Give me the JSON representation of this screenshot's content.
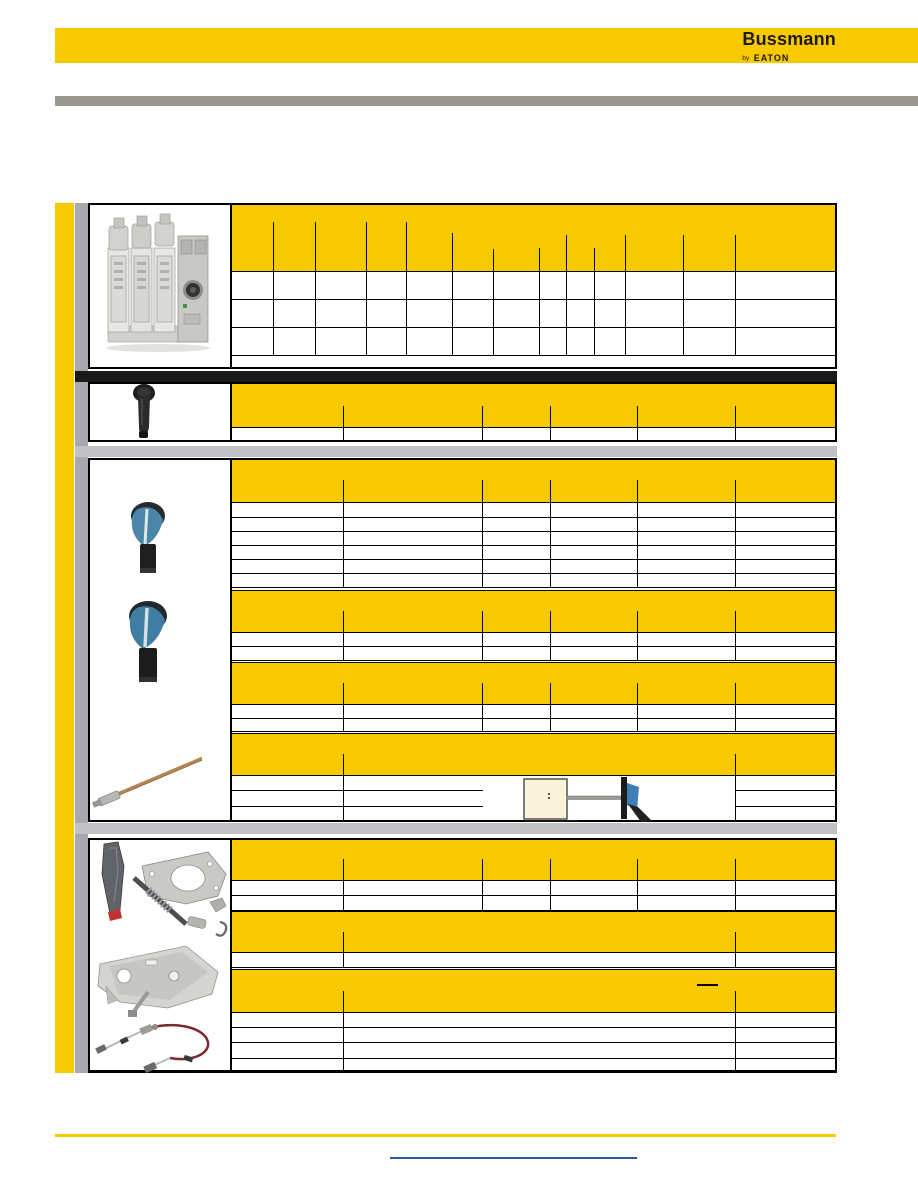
{
  "brand": {
    "name": "Bussmann",
    "byline": "by",
    "parent": "EATON"
  },
  "colors": {
    "yellow": "#F7CA00",
    "top_gray": "#97978F",
    "separator_gray": "#C2C2C5",
    "stripe_gray": "#A9A9AC",
    "black_bar": "#1A1A1A",
    "link_blue": "#2B57A8",
    "border": "#000000",
    "page_bg": "#FFFFFF"
  },
  "footer": {
    "link_underline_only": true
  },
  "images": [
    "fuse-switch-disconnector-product-photo",
    "black-rotary-handle-photo",
    "blue-rotary-handle-photo",
    "blue-rotary-handle-large-photo",
    "extension-shaft-photo",
    "interlock-mechanism-parts-photo",
    "mounting-bracket-plate-photo",
    "bowden-cable-photo",
    "door-mounted-handle-diagram"
  ],
  "grid": {
    "bars": [
      {
        "n": "left-yellow-stripe",
        "x": 55,
        "y": 203,
        "w": 19,
        "h": 870,
        "c": "yellow"
      },
      {
        "n": "left-gray-stripe",
        "x": 75,
        "y": 203,
        "w": 13,
        "h": 870,
        "c": "stripe_gray"
      },
      {
        "n": "black-separator-bar",
        "x": 75,
        "y": 371,
        "w": 762,
        "h": 11,
        "c": "black_bar"
      },
      {
        "n": "gray-separator-bar-1",
        "x": 75,
        "y": 446,
        "w": 762,
        "h": 11,
        "c": "separator_gray"
      },
      {
        "n": "gray-separator-bar-2",
        "x": 75,
        "y": 823,
        "w": 762,
        "h": 11,
        "c": "separator_gray"
      }
    ],
    "bands": [
      [
        230,
        203,
        607,
        68
      ],
      [
        230,
        383,
        607,
        44
      ],
      [
        230,
        458,
        607,
        44
      ],
      [
        230,
        590,
        607,
        42
      ],
      [
        230,
        662,
        607,
        42
      ],
      [
        230,
        733,
        607,
        42
      ],
      [
        230,
        838,
        607,
        42
      ],
      [
        230,
        911,
        607,
        41
      ],
      [
        230,
        969,
        607,
        43
      ]
    ],
    "boxes": [
      [
        88,
        203,
        749,
        166
      ],
      [
        88,
        382,
        749,
        60
      ],
      [
        88,
        458,
        749,
        364
      ],
      [
        88,
        838,
        749,
        235
      ]
    ],
    "hlines": [
      [
        230,
        271,
        607
      ],
      [
        230,
        299,
        607
      ],
      [
        230,
        327,
        607
      ],
      [
        230,
        355,
        607
      ],
      [
        230,
        427,
        607
      ],
      [
        230,
        502,
        607
      ],
      [
        230,
        517,
        607
      ],
      [
        230,
        531,
        607
      ],
      [
        230,
        545,
        607
      ],
      [
        230,
        559,
        607
      ],
      [
        230,
        573,
        607
      ],
      [
        230,
        587,
        607
      ],
      [
        230,
        590,
        607
      ],
      [
        230,
        632,
        607
      ],
      [
        230,
        646,
        607
      ],
      [
        230,
        660,
        607
      ],
      [
        230,
        662,
        607
      ],
      [
        230,
        704,
        607
      ],
      [
        230,
        718,
        607
      ],
      [
        230,
        731,
        607
      ],
      [
        230,
        733,
        607
      ],
      [
        230,
        775,
        607
      ],
      [
        230,
        790,
        253
      ],
      [
        230,
        806,
        253
      ],
      [
        735,
        790,
        102
      ],
      [
        735,
        806,
        102
      ],
      [
        230,
        880,
        607
      ],
      [
        230,
        895,
        607
      ],
      [
        230,
        910,
        607
      ],
      [
        230,
        911,
        607
      ],
      [
        230,
        952,
        607
      ],
      [
        230,
        967,
        607
      ],
      [
        230,
        969,
        607
      ],
      [
        230,
        1012,
        607
      ],
      [
        230,
        1027,
        607
      ],
      [
        230,
        1042,
        607
      ],
      [
        230,
        1058,
        607
      ],
      [
        697,
        984,
        21,
        2
      ]
    ],
    "vlines": [
      [
        230,
        203,
        166,
        2
      ],
      [
        230,
        382,
        60,
        2
      ],
      [
        230,
        458,
        364,
        2
      ],
      [
        230,
        838,
        235,
        2
      ],
      [
        273,
        222,
        49
      ],
      [
        315,
        222,
        49
      ],
      [
        366,
        222,
        49
      ],
      [
        406,
        222,
        49
      ],
      [
        452,
        233,
        38
      ],
      [
        493,
        249,
        22
      ],
      [
        539,
        248,
        23
      ],
      [
        566,
        235,
        36
      ],
      [
        594,
        248,
        23
      ],
      [
        625,
        235,
        36
      ],
      [
        683,
        235,
        36
      ],
      [
        735,
        235,
        36
      ],
      [
        273,
        271,
        84
      ],
      [
        315,
        271,
        84
      ],
      [
        366,
        271,
        84
      ],
      [
        406,
        271,
        84
      ],
      [
        452,
        271,
        84
      ],
      [
        493,
        271,
        84
      ],
      [
        539,
        271,
        84
      ],
      [
        566,
        271,
        84
      ],
      [
        594,
        271,
        84
      ],
      [
        625,
        271,
        84
      ],
      [
        683,
        271,
        84
      ],
      [
        735,
        271,
        84
      ],
      [
        343,
        406,
        21
      ],
      [
        482,
        406,
        21
      ],
      [
        550,
        406,
        21
      ],
      [
        637,
        406,
        21
      ],
      [
        735,
        406,
        21
      ],
      [
        343,
        427,
        15
      ],
      [
        482,
        427,
        15
      ],
      [
        550,
        427,
        15
      ],
      [
        637,
        427,
        15
      ],
      [
        735,
        427,
        15
      ],
      [
        343,
        480,
        22
      ],
      [
        482,
        480,
        22
      ],
      [
        550,
        480,
        22
      ],
      [
        637,
        480,
        22
      ],
      [
        735,
        480,
        22
      ],
      [
        343,
        502,
        85
      ],
      [
        482,
        502,
        85
      ],
      [
        550,
        502,
        85
      ],
      [
        637,
        502,
        85
      ],
      [
        735,
        502,
        85
      ],
      [
        343,
        611,
        21
      ],
      [
        482,
        611,
        21
      ],
      [
        550,
        611,
        21
      ],
      [
        637,
        611,
        21
      ],
      [
        735,
        611,
        21
      ],
      [
        343,
        632,
        28
      ],
      [
        482,
        632,
        28
      ],
      [
        550,
        632,
        28
      ],
      [
        637,
        632,
        28
      ],
      [
        735,
        632,
        28
      ],
      [
        343,
        683,
        21
      ],
      [
        482,
        683,
        21
      ],
      [
        550,
        683,
        21
      ],
      [
        637,
        683,
        21
      ],
      [
        735,
        683,
        21
      ],
      [
        343,
        704,
        27
      ],
      [
        482,
        704,
        27
      ],
      [
        550,
        704,
        27
      ],
      [
        637,
        704,
        27
      ],
      [
        735,
        704,
        27
      ],
      [
        343,
        754,
        21
      ],
      [
        735,
        754,
        21
      ],
      [
        343,
        775,
        47
      ],
      [
        735,
        775,
        47
      ],
      [
        343,
        859,
        21
      ],
      [
        482,
        859,
        21
      ],
      [
        550,
        859,
        21
      ],
      [
        637,
        859,
        21
      ],
      [
        735,
        859,
        21
      ],
      [
        343,
        880,
        30
      ],
      [
        482,
        880,
        30
      ],
      [
        550,
        880,
        30
      ],
      [
        637,
        880,
        30
      ],
      [
        735,
        880,
        30
      ],
      [
        343,
        932,
        20
      ],
      [
        735,
        932,
        20
      ],
      [
        343,
        952,
        15
      ],
      [
        735,
        952,
        15
      ],
      [
        343,
        991,
        21
      ],
      [
        735,
        991,
        21
      ],
      [
        343,
        1012,
        61
      ],
      [
        735,
        1012,
        61
      ]
    ]
  }
}
